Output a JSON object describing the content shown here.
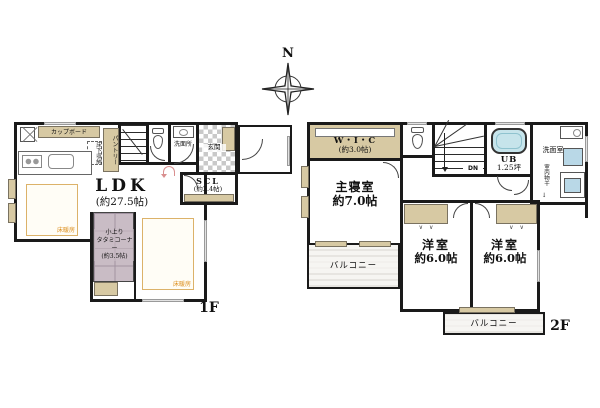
{
  "compass": {
    "north_label": "N"
  },
  "floor1": {
    "floor_label": "1F",
    "ldk": {
      "name": "LDK",
      "size": "(約27.5帖)"
    },
    "kitchen": {
      "cupboard": "カップボード",
      "pantry": "パントリー",
      "underfloor_storage": "床下収納"
    },
    "tatami_corner": {
      "line1": "小上り",
      "line2": "タタミコーナー",
      "size": "(約3.5帖)"
    },
    "entrance": {
      "label": "玄関"
    },
    "scl": {
      "name": "SCL",
      "size": "(約2.4帖)"
    },
    "washroom": {
      "label": "洗面所"
    },
    "floor_heating": {
      "label": "床暖房"
    }
  },
  "floor2": {
    "floor_label": "2F",
    "wic": {
      "name": "W・I・C",
      "size": "(約3.0帖)"
    },
    "master_bedroom": {
      "name": "主寝室",
      "size": "約7.0帖"
    },
    "unit_bath": {
      "name": "UB",
      "size": "1.25坪"
    },
    "washroom": {
      "label": "洗面室",
      "indoor_drying": "室内物干",
      "arrow_down": "↓"
    },
    "stairs": {
      "down_label": "DN"
    },
    "bedroom_center": {
      "name": "洋室",
      "size": "約6.0帖"
    },
    "bedroom_right": {
      "name": "洋室",
      "size": "約6.0帖"
    },
    "balcony_left": {
      "label": "バルコニー"
    },
    "balcony_bottom": {
      "label": "バルコニー"
    },
    "closet_marks": "∨　∨"
  },
  "colors": {
    "wall": "#1a1a1a",
    "tan": "#d7c9a3",
    "tatami": "#c9bcc5",
    "bath": "#c6e4eb",
    "floor_heating_accent": "#dd8f1e"
  }
}
